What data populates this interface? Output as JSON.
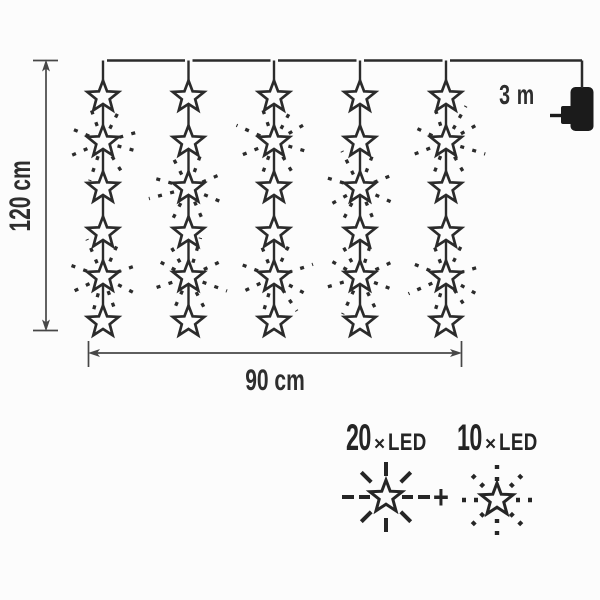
{
  "labels": {
    "height": "120 cm",
    "width": "90 cm",
    "cable_length": "3 m",
    "plus": "+"
  },
  "legend": [
    {
      "count": "20",
      "times": "×",
      "unit": "LED",
      "ray_style": "solid-rays"
    },
    {
      "count": "10",
      "times": "×",
      "unit": "LED",
      "ray_style": "dotted-rays"
    }
  ],
  "diagram": {
    "strand_count": 5,
    "stars_per_strand": 6,
    "total_stars": 30,
    "burst_pattern": [
      [
        2,
        5
      ],
      [
        3,
        5
      ],
      [
        2,
        5
      ],
      [
        3,
        5
      ],
      [
        2,
        5
      ]
    ]
  },
  "colors": {
    "ink": "#2b2b2b",
    "dimension": "#474747",
    "plug": "#1b1b1b",
    "background": "#fcfcfc"
  }
}
